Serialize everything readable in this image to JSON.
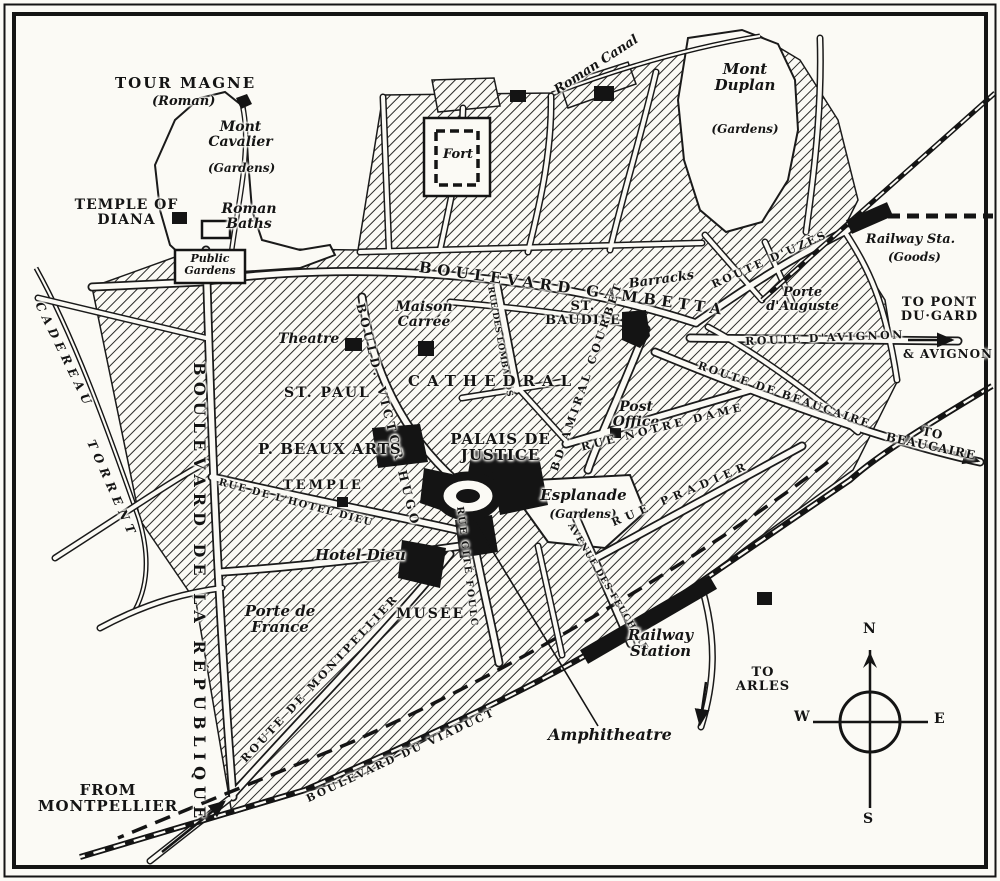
{
  "map_type": "historic city plan of Nimes",
  "colors": {
    "paper": "#fbfaf5",
    "ink": "#141414"
  },
  "labels": {
    "monuments": {
      "tour_magne": "TOUR MAGNE",
      "tour_magne_sub": "(Roman)",
      "temple_diana": "TEMPLE OF DIANA",
      "roman_baths": "Roman Baths",
      "fort": "Fort",
      "theatre": "Theatre",
      "maison_carree": "Maison Carrée",
      "cathedral": "CATHEDRAL",
      "st_paul": "ST. PAUL",
      "st_baudile": "ST. BAUDILE",
      "beaux_arts": "P. BEAUX ARTS",
      "temple": "TEMPLE",
      "palais_justice": "PALAIS DE JUSTICE",
      "post_office": "Post Office",
      "hotel_dieu": "Hotel Dieu",
      "porte_auguste": "Porte d'Auguste",
      "porte_france": "Porte de France",
      "musee": "MUSÉE",
      "amphitheatre": "Amphitheatre"
    },
    "areas": {
      "mont_cavalier": "Mont Cavalier",
      "mont_cavalier_sub": "(Gardens)",
      "mont_duplan": "Mont Duplan",
      "mont_duplan_sub": "(Gardens)",
      "public_gardens": "Public Gardens",
      "esplanade": "Esplanade",
      "esplanade_sub": "(Gardens)",
      "barracks": "Barracks",
      "roman_canal": "Roman Canal"
    },
    "stations": {
      "railway_station": "Railway Station",
      "railway_goods": "Railway Sta.",
      "railway_goods_sub": "(Goods)"
    },
    "streets": {
      "gambetta": "BOULEVARD GAMBETTA",
      "republique": "BOULEVARD DE LA RÉPUBLIQUE",
      "victor_hugo": "BOULD. VICTOR HUGO",
      "lombards": "RUE DES LOMBARDS",
      "notre_dame": "RUE NOTRE DAME",
      "amiral_courbet": "BD AMIRAL COURBET",
      "pradier": "RUE PRADIER",
      "feucheres": "AVENUE DES FEUCHÈRES",
      "cite_foulc": "RUE CITÉ FOULC",
      "hotel_dieu_rue": "RUE DE L'HOTEL DIEU",
      "uzes": "ROUTE D'UZÈS",
      "avignon": "ROUTE D'AVIGNON",
      "beaucaire": "ROUTE DE BEAUCAIRE",
      "montpellier": "ROUTE DE MONTPELLIER",
      "viaduct": "BOULEVARD DU VIADUCT",
      "cadereau": "CADEREAU",
      "torrent": "TORRENT"
    },
    "directions": {
      "pont_du_gard": "TO PONT DU·GARD",
      "avignon_dest": "& AVIGNON",
      "beaucaire_dest": "TO BEAUCAIRE",
      "arles": "TO ARLES",
      "from_montpellier": "FROM MONTPELLIER"
    },
    "compass": {
      "n": "N",
      "s": "S",
      "e": "E",
      "w": "W"
    }
  }
}
